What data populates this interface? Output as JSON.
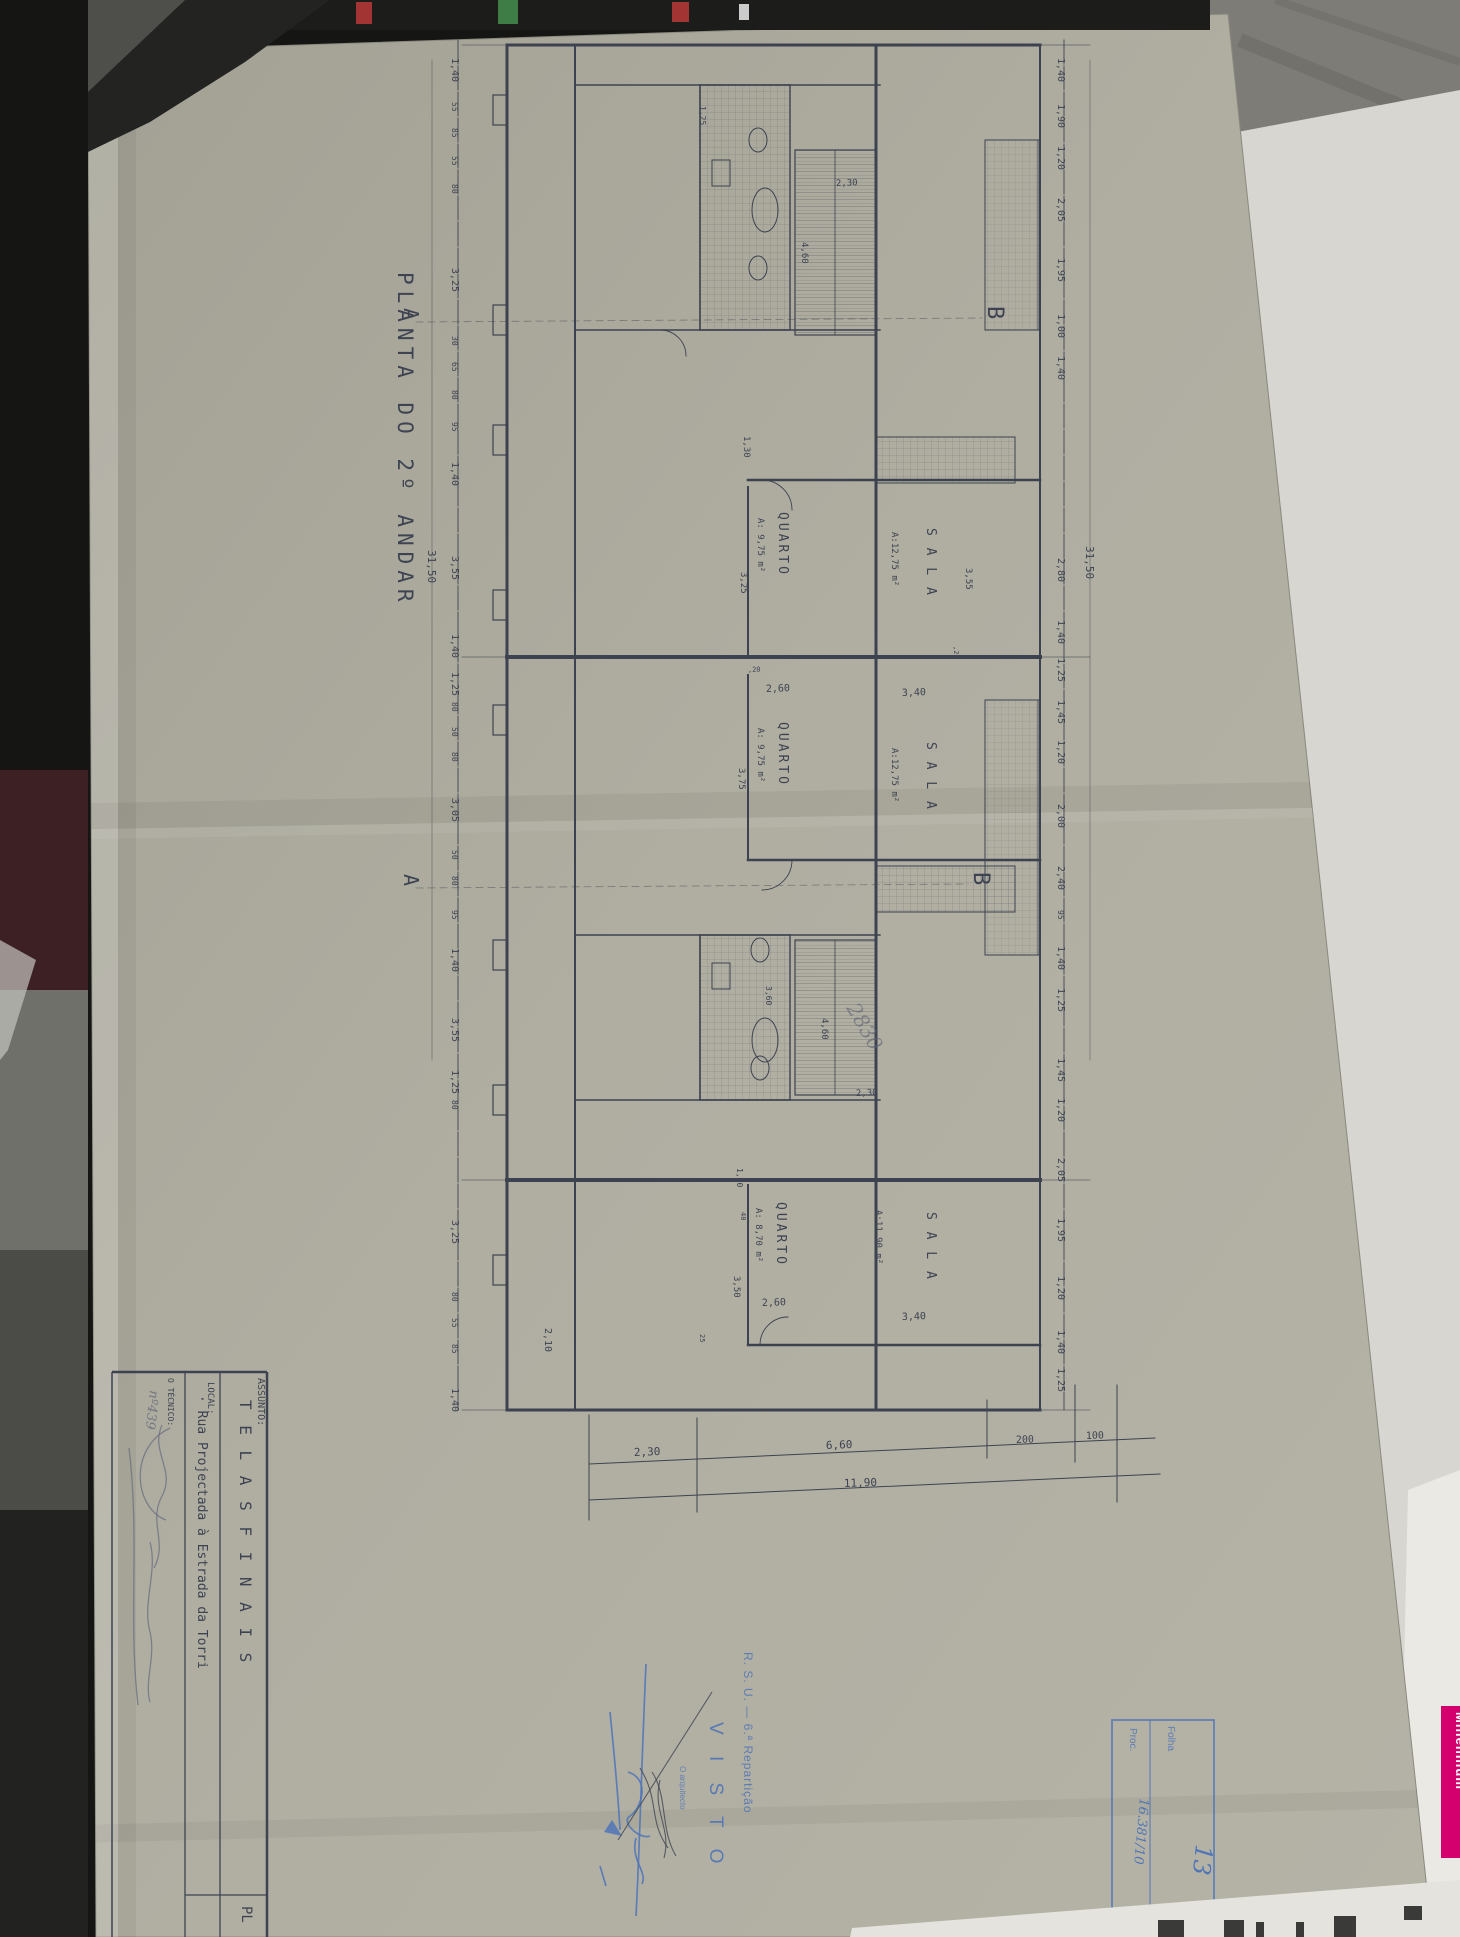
{
  "sheet": {
    "title": "PLANTA  DO  2º  ANDAR",
    "title_block": {
      "assunto_label": "ASSUNTO:",
      "assunto_value": "T E L A S   F I N A I S",
      "local_label": "LOCAL:",
      "local_value": "· Rua Projectada à Estrada da Torri",
      "tecnico_label": "O TÉCNICO:",
      "tecnico_number": "nº439",
      "corner_text": "PL"
    },
    "stamps": {
      "visto": {
        "line1": "R. S. U. — 6.ª Repartição",
        "line2": "V I S T O",
        "line3": "O arquitecto"
      },
      "folha": {
        "folha_label": "Folha",
        "folha_value": "13",
        "proc_label": "Proc.",
        "proc_value": "16.381/10"
      }
    },
    "plan_texts": [
      {
        "t": "1,40",
        "x": 452,
        "y": 58
      },
      {
        "t": "55",
        "x": 452,
        "y": 102,
        "s": 8
      },
      {
        "t": "85",
        "x": 452,
        "y": 128,
        "s": 8
      },
      {
        "t": "55",
        "x": 452,
        "y": 156,
        "s": 8
      },
      {
        "t": "80",
        "x": 452,
        "y": 184,
        "s": 8
      },
      {
        "t": "3,25",
        "x": 452,
        "y": 268
      },
      {
        "t": "30",
        "x": 452,
        "y": 336,
        "s": 8
      },
      {
        "t": "65",
        "x": 452,
        "y": 362,
        "s": 8
      },
      {
        "t": "80",
        "x": 452,
        "y": 390,
        "s": 8
      },
      {
        "t": "95",
        "x": 452,
        "y": 422,
        "s": 8
      },
      {
        "t": "1,40",
        "x": 452,
        "y": 462
      },
      {
        "t": "3,55",
        "x": 452,
        "y": 556
      },
      {
        "t": "1,40",
        "x": 452,
        "y": 634
      },
      {
        "t": "1,25",
        "x": 452,
        "y": 672
      },
      {
        "t": "80",
        "x": 452,
        "y": 702,
        "s": 8
      },
      {
        "t": "50",
        "x": 452,
        "y": 727,
        "s": 8
      },
      {
        "t": "80",
        "x": 452,
        "y": 752,
        "s": 8
      },
      {
        "t": "3,05",
        "x": 452,
        "y": 798
      },
      {
        "t": "50",
        "x": 452,
        "y": 850,
        "s": 8
      },
      {
        "t": "80",
        "x": 452,
        "y": 876,
        "s": 8
      },
      {
        "t": "95",
        "x": 452,
        "y": 910,
        "s": 8
      },
      {
        "t": "1,40",
        "x": 452,
        "y": 948
      },
      {
        "t": "3,55",
        "x": 452,
        "y": 1018
      },
      {
        "t": "1,25",
        "x": 452,
        "y": 1070
      },
      {
        "t": "80",
        "x": 452,
        "y": 1100,
        "s": 8
      },
      {
        "t": "3,25",
        "x": 452,
        "y": 1220
      },
      {
        "t": "80",
        "x": 452,
        "y": 1292,
        "s": 8
      },
      {
        "t": "55",
        "x": 452,
        "y": 1318,
        "s": 8
      },
      {
        "t": "85",
        "x": 452,
        "y": 1344,
        "s": 8
      },
      {
        "t": "1,40",
        "x": 452,
        "y": 1388
      },
      {
        "t": "31,50",
        "x": 428,
        "y": 550,
        "s": 11
      },
      {
        "t": "1,40",
        "x": 1058,
        "y": 58
      },
      {
        "t": "1,90",
        "x": 1058,
        "y": 104
      },
      {
        "t": "1,20",
        "x": 1058,
        "y": 146
      },
      {
        "t": "2,05",
        "x": 1058,
        "y": 198
      },
      {
        "t": "1,95",
        "x": 1058,
        "y": 258
      },
      {
        "t": "1,00",
        "x": 1058,
        "y": 314
      },
      {
        "t": "1,40",
        "x": 1058,
        "y": 356
      },
      {
        "t": "2,80",
        "x": 1058,
        "y": 558
      },
      {
        "t": "1,40",
        "x": 1058,
        "y": 620
      },
      {
        "t": "1,25",
        "x": 1058,
        "y": 658
      },
      {
        "t": "1,45",
        "x": 1058,
        "y": 700
      },
      {
        "t": "1,20",
        "x": 1058,
        "y": 740
      },
      {
        "t": "2,00",
        "x": 1058,
        "y": 804
      },
      {
        "t": "2,40",
        "x": 1058,
        "y": 866
      },
      {
        "t": "95",
        "x": 1058,
        "y": 910,
        "s": 8
      },
      {
        "t": "1,40",
        "x": 1058,
        "y": 946
      },
      {
        "t": "1,25",
        "x": 1058,
        "y": 988
      },
      {
        "t": "1,45",
        "x": 1058,
        "y": 1058
      },
      {
        "t": "1,20",
        "x": 1058,
        "y": 1098
      },
      {
        "t": "2,05",
        "x": 1058,
        "y": 1158
      },
      {
        "t": "1,95",
        "x": 1058,
        "y": 1218
      },
      {
        "t": "1,20",
        "x": 1058,
        "y": 1276
      },
      {
        "t": "1,40",
        "x": 1058,
        "y": 1330
      },
      {
        "t": "1,25",
        "x": 1058,
        "y": 1368
      },
      {
        "t": "31,50",
        "x": 1086,
        "y": 546,
        "s": 11
      },
      {
        "t": "2,30",
        "x": 634,
        "y": 1456,
        "r": -2,
        "s": 11
      },
      {
        "t": "6,60",
        "x": 826,
        "y": 1449,
        "r": -2,
        "s": 11
      },
      {
        "t": "200",
        "x": 1016,
        "y": 1443,
        "r": -2,
        "s": 10
      },
      {
        "t": "100",
        "x": 1086,
        "y": 1439,
        "r": -2,
        "s": 10
      },
      {
        "t": "11,90",
        "x": 844,
        "y": 1487,
        "r": -2,
        "s": 11
      },
      {
        "t": "2,30",
        "x": 836,
        "y": 186,
        "r": -2,
        "s": 9
      },
      {
        "t": "4,60",
        "x": 802,
        "y": 242,
        "s": 9
      },
      {
        "t": "1,25",
        "x": 700,
        "y": 106,
        "s": 8
      },
      {
        "t": "1,30",
        "x": 744,
        "y": 436,
        "s": 9
      },
      {
        "t": "3,55",
        "x": 966,
        "y": 568,
        "s": 9
      },
      {
        "t": ",20",
        "x": 954,
        "y": 646,
        "s": 7
      },
      {
        "t": "3,25",
        "x": 741,
        "y": 572,
        "s": 9
      },
      {
        "t": "2,60",
        "x": 766,
        "y": 692,
        "r": -2,
        "s": 10
      },
      {
        "t": ",20",
        "x": 748,
        "y": 672,
        "r": -2,
        "s": 7
      },
      {
        "t": "3,40",
        "x": 902,
        "y": 696,
        "r": -2,
        "s": 10
      },
      {
        "t": "3,75",
        "x": 739,
        "y": 768,
        "s": 9
      },
      {
        "t": "3,60",
        "x": 766,
        "y": 986,
        "s": 8
      },
      {
        "t": "4,60",
        "x": 822,
        "y": 1018,
        "s": 9
      },
      {
        "t": "2,30",
        "x": 856,
        "y": 1096,
        "r": -2,
        "s": 9
      },
      {
        "t": "1,10",
        "x": 737,
        "y": 1168,
        "s": 8
      },
      {
        "t": "40",
        "x": 741,
        "y": 1212,
        "s": 7
      },
      {
        "t": "3,50",
        "x": 734,
        "y": 1276,
        "s": 9
      },
      {
        "t": "2,60",
        "x": 762,
        "y": 1306,
        "r": -2,
        "s": 10
      },
      {
        "t": "25",
        "x": 700,
        "y": 1334,
        "s": 7
      },
      {
        "t": "2,10",
        "x": 545,
        "y": 1328,
        "s": 10
      },
      {
        "t": "3,40",
        "x": 902,
        "y": 1320,
        "r": -2,
        "s": 10
      },
      {
        "t": "QUARTO",
        "x": 779,
        "y": 512,
        "s": 13,
        "ls": 3
      },
      {
        "t": "A: 9,75 m²",
        "x": 758,
        "y": 518,
        "s": 9
      },
      {
        "t": "S A L A",
        "x": 927,
        "y": 528,
        "s": 13,
        "ls": 2
      },
      {
        "t": "A:12,75 m²",
        "x": 892,
        "y": 532,
        "s": 9
      },
      {
        "t": "QUARTO",
        "x": 779,
        "y": 722,
        "s": 13,
        "ls": 3
      },
      {
        "t": "A: 9,75 m²",
        "x": 758,
        "y": 728,
        "s": 9
      },
      {
        "t": "S A L A",
        "x": 927,
        "y": 742,
        "s": 13,
        "ls": 2
      },
      {
        "t": "A:12,75 m²",
        "x": 892,
        "y": 748,
        "s": 9
      },
      {
        "t": "QUARTO",
        "x": 777,
        "y": 1202,
        "s": 13,
        "ls": 3
      },
      {
        "t": "A: 8,70 m²",
        "x": 756,
        "y": 1208,
        "s": 9
      },
      {
        "t": "S A L A",
        "x": 927,
        "y": 1212,
        "s": 13,
        "ls": 2
      },
      {
        "t": "A:11,90 m²",
        "x": 876,
        "y": 1210,
        "s": 9
      },
      {
        "t": "A",
        "x": 404,
        "y": 308,
        "s": 20
      },
      {
        "t": "B",
        "x": 988,
        "y": 306,
        "s": 22
      },
      {
        "t": "A",
        "x": 404,
        "y": 874,
        "s": 20
      },
      {
        "t": "B",
        "x": 974,
        "y": 872,
        "s": 22
      },
      {
        "t": "2830",
        "x": 846,
        "y": 1008,
        "r": 60,
        "s": 20,
        "cls": "p"
      }
    ]
  },
  "surroundings": {
    "brand_text": "Millennium",
    "brand_color": "#d4006e"
  },
  "colors": {
    "paper": "#aeac9f",
    "ink": "#3d4352",
    "stamp_blue": "#4f74b8"
  }
}
